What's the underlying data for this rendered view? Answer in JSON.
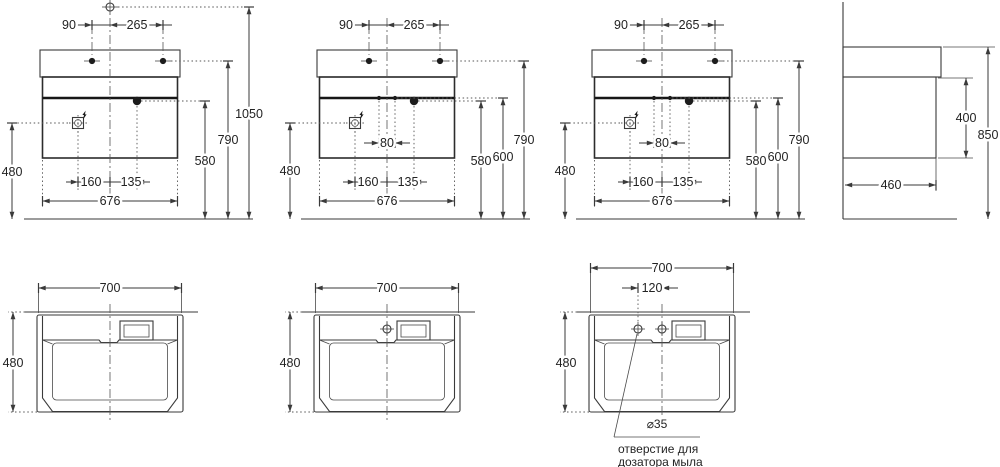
{
  "drawing": {
    "type": "technical-dimension-drawing",
    "subject": "wall-hung washbasin with cabinet",
    "line_color": "#3a3a3a",
    "background": "#ffffff"
  },
  "views": {
    "front1": {
      "dims": {
        "d90": "90",
        "d265": "265",
        "d1050": "1050",
        "d790": "790",
        "d580": "580",
        "d480": "480",
        "d160": "160",
        "d135": "135",
        "d676": "676"
      }
    },
    "front2": {
      "dims": {
        "d90": "90",
        "d265": "265",
        "d80": "80",
        "d790": "790",
        "d600": "600",
        "d580": "580",
        "d480": "480",
        "d160": "160",
        "d135": "135",
        "d676": "676"
      }
    },
    "front3": {
      "dims": {
        "d90": "90",
        "d265": "265",
        "d80": "80",
        "d790": "790",
        "d600": "600",
        "d580": "580",
        "d480": "480",
        "d160": "160",
        "d135": "135",
        "d676": "676"
      }
    },
    "side": {
      "dims": {
        "d400": "400",
        "d850": "850",
        "d460": "460"
      }
    },
    "top1": {
      "dims": {
        "d700": "700",
        "d480": "480"
      }
    },
    "top2": {
      "dims": {
        "d700": "700",
        "d480": "480"
      }
    },
    "top3": {
      "dims": {
        "d700": "700",
        "d120": "120",
        "d480": "480",
        "dia": "⌀35"
      },
      "note": {
        "line1": "отверстие для",
        "line2": "дозатора мыла"
      }
    }
  }
}
